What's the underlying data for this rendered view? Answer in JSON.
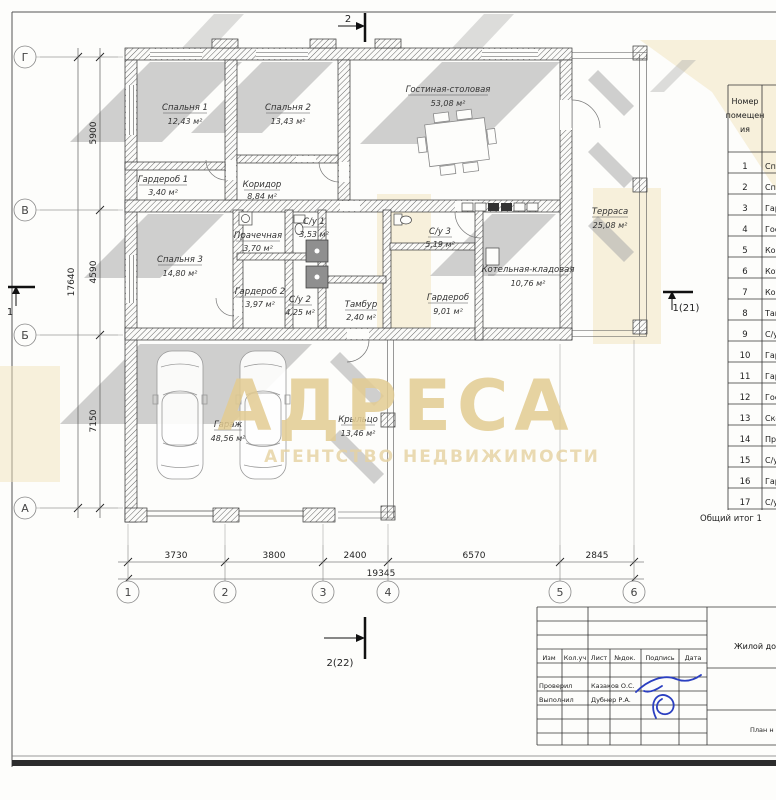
{
  "plan": {
    "grid_cols": [
      "1",
      "2",
      "3",
      "4",
      "5",
      "6"
    ],
    "grid_rows": [
      "Г",
      "В",
      "Б",
      "А"
    ],
    "dims_bottom": [
      "3730",
      "3800",
      "2400",
      "6570",
      "2845"
    ],
    "dims_bottom_total": "19345",
    "dims_left": [
      "5900",
      "4590",
      "7150"
    ],
    "dims_left_total": "17640",
    "sections": {
      "top": "2",
      "bottom": "2(22)",
      "left": "1",
      "right": "1(21)"
    },
    "rooms": [
      {
        "label": "Спальня 1",
        "area": "12,43 м²"
      },
      {
        "label": "Спальня 2",
        "area": "13,43 м²"
      },
      {
        "label": "Гостиная-столовая",
        "area": "53,08 м²"
      },
      {
        "label": "Гардероб 1",
        "area": "3,40 м²"
      },
      {
        "label": "Коридор",
        "area": "8,84 м²"
      },
      {
        "label": "Терраса",
        "area": "25,08 м²"
      },
      {
        "label": "Прачечная",
        "area": "3,70 м²"
      },
      {
        "label": "С/у 1",
        "area": "3,53 м²"
      },
      {
        "label": "Спальня 3",
        "area": "14,80 м²"
      },
      {
        "label": "Гардероб 2",
        "area": "3,97 м²"
      },
      {
        "label": "С/у 2",
        "area": "4,25 м²"
      },
      {
        "label": "С/у 3",
        "area": "5,19 м²"
      },
      {
        "label": "Тамбур",
        "area": "2,40 м²"
      },
      {
        "label": "Гардероб",
        "area": "9,01 м²"
      },
      {
        "label": "Котельная-кладовая",
        "area": "10,76 м²"
      },
      {
        "label": "Гараж",
        "area": "48,56 м²"
      },
      {
        "label": "Крыльцо",
        "area": "13,46 м²"
      }
    ]
  },
  "watermark": {
    "title": "АДРЕСА",
    "subtitle": "АГЕНТСТВО НЕДВИЖИМОСТИ",
    "color": "#e3cc92"
  },
  "room_table": {
    "header_lines": [
      "Номер",
      "помещен",
      "ия"
    ],
    "rows": [
      [
        "1",
        "Сп"
      ],
      [
        "2",
        "Сп"
      ],
      [
        "3",
        "Гар"
      ],
      [
        "4",
        "Гос"
      ],
      [
        "5",
        "Кор"
      ],
      [
        "6",
        "Кот"
      ],
      [
        "7",
        "Кор"
      ],
      [
        "8",
        "Там"
      ],
      [
        "9",
        "С/у"
      ],
      [
        "10",
        "Гар"
      ],
      [
        "11",
        "Гар"
      ],
      [
        "12",
        "Гос"
      ],
      [
        "13",
        "Ско"
      ],
      [
        "14",
        "Пра"
      ],
      [
        "15",
        "С/у"
      ],
      [
        "16",
        "Гар"
      ],
      [
        "17",
        "С/у"
      ]
    ],
    "footer": "Общий итог 1"
  },
  "title_block": {
    "columns": [
      "Изм",
      "Кол.уч",
      "Лист",
      "№док.",
      "Подпись",
      "Дата"
    ],
    "checked_role": "Проверил",
    "checked_name": "Казаков О.С.",
    "made_role": "Выполнил",
    "made_name": "Дубнер Р.А.",
    "project": "Жилой дом",
    "doc": "План н"
  }
}
